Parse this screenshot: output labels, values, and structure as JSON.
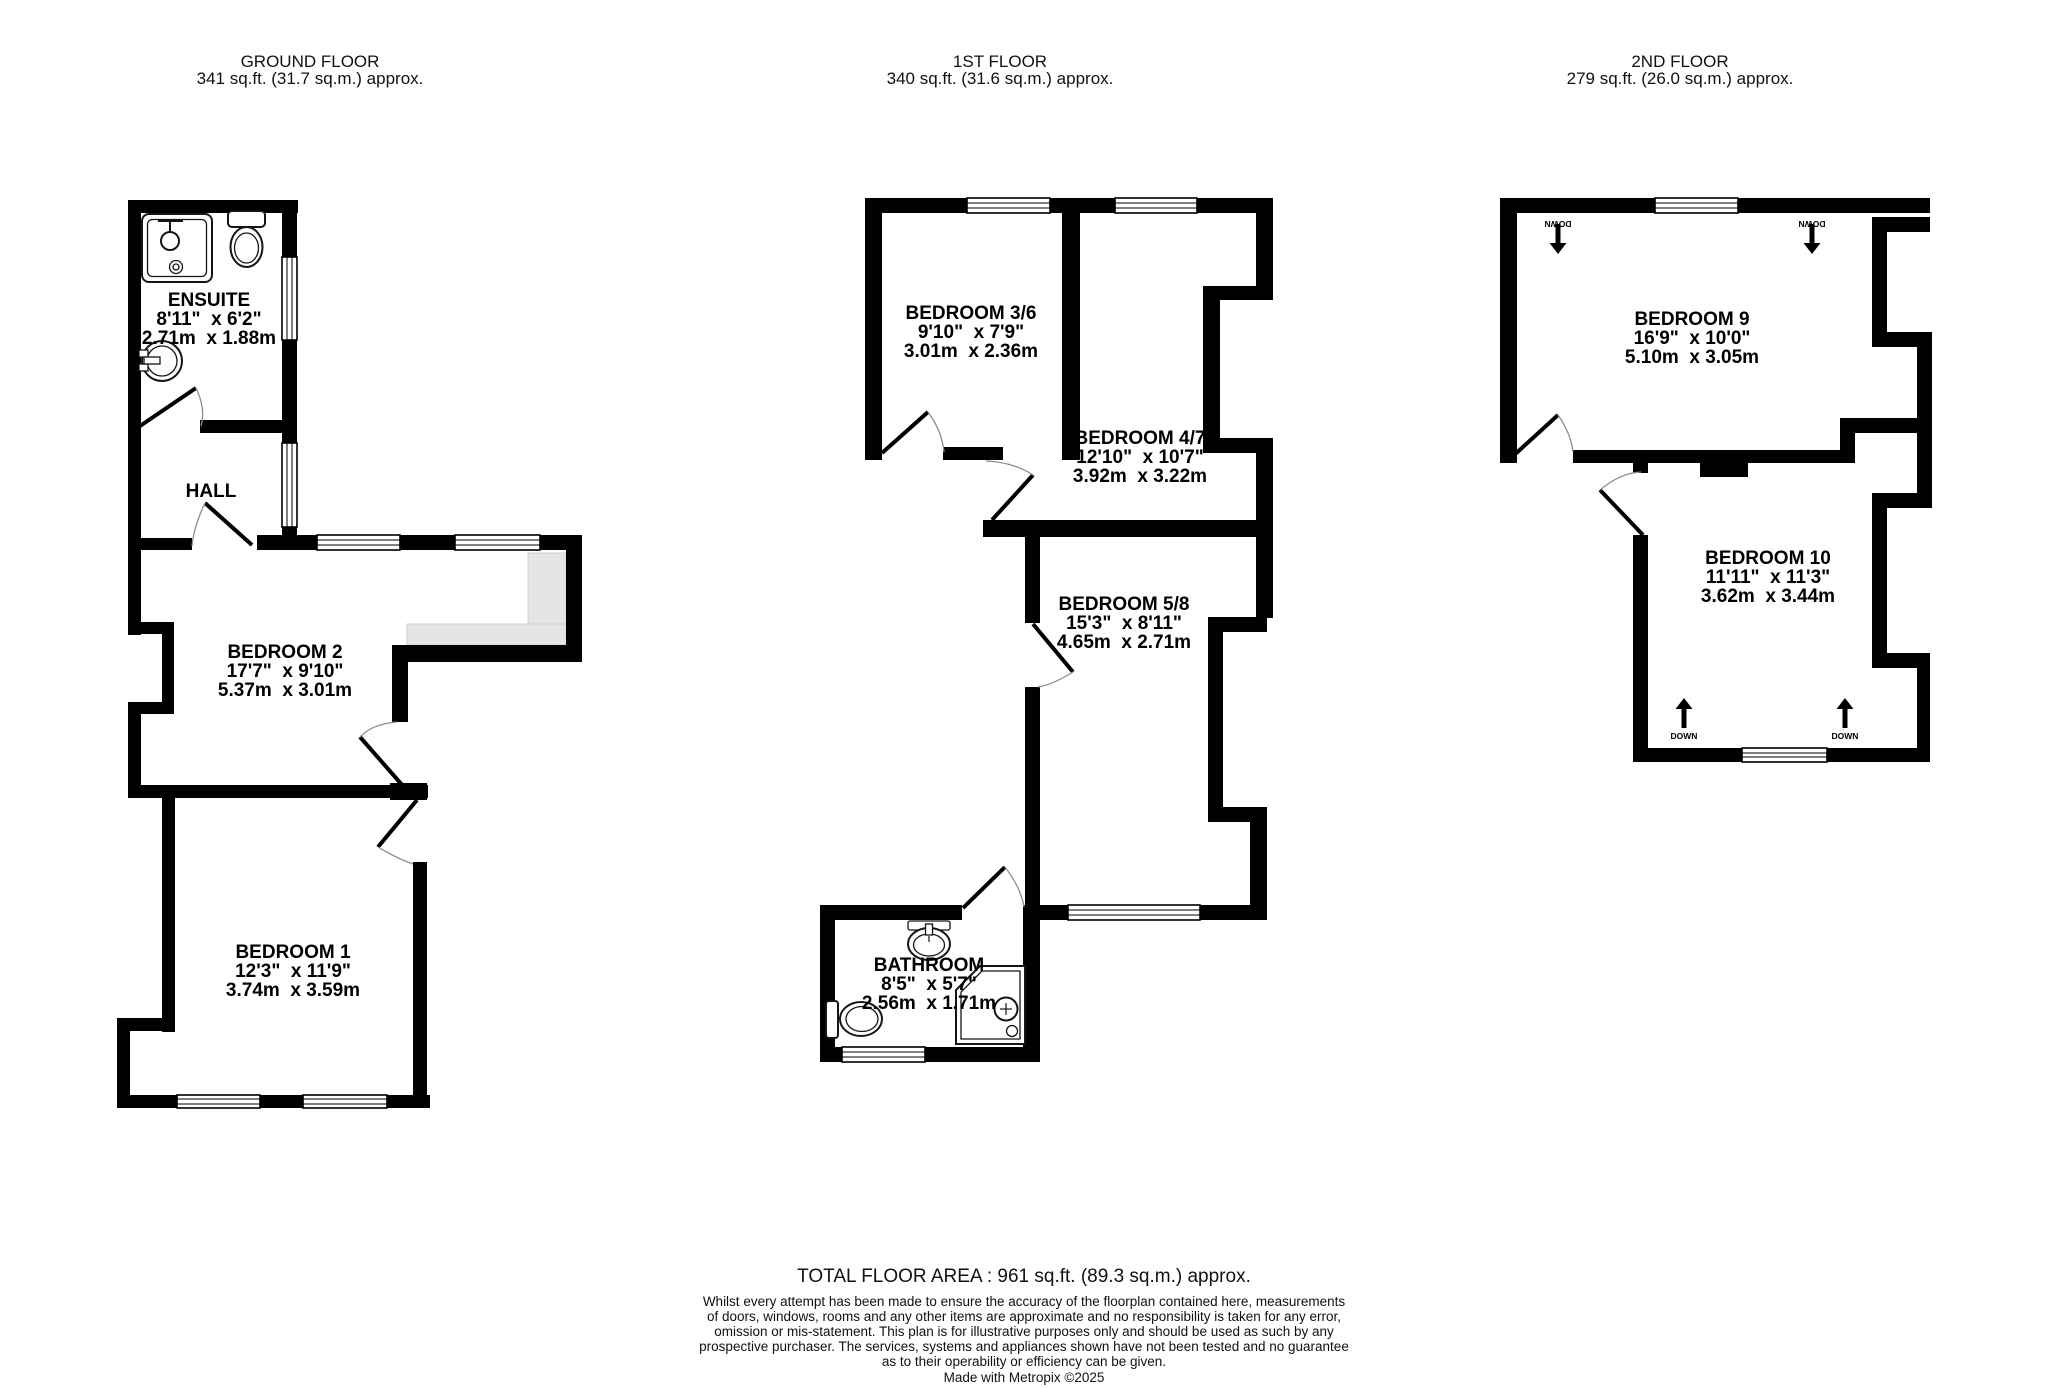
{
  "ground": {
    "label": "GROUND FLOOR",
    "area": "341 sq.ft. (31.7 sq.m.) approx."
  },
  "first": {
    "label": "1ST FLOOR",
    "area": "340 sq.ft. (31.6 sq.m.) approx."
  },
  "second": {
    "label": "2ND FLOOR",
    "area": "279 sq.ft. (26.0 sq.m.) approx."
  },
  "rooms": {
    "ensuite": {
      "name": "ENSUITE",
      "imperial": "8'11\"  x 6'2\"",
      "metric": "2.71m  x 1.88m"
    },
    "hall": {
      "name": "HALL"
    },
    "bedroom2": {
      "name": "BEDROOM 2",
      "imperial": "17'7\"  x 9'10\"",
      "metric": "5.37m  x 3.01m"
    },
    "bedroom1": {
      "name": "BEDROOM 1",
      "imperial": "12'3\"  x 11'9\"",
      "metric": "3.74m  x 3.59m"
    },
    "bedroom36": {
      "name": "BEDROOM 3/6",
      "imperial": "9'10\"  x 7'9\"",
      "metric": "3.01m  x 2.36m"
    },
    "bedroom47": {
      "name": "BEDROOM 4/7",
      "imperial": "12'10\"  x 10'7\"",
      "metric": "3.92m  x 3.22m"
    },
    "bedroom58": {
      "name": "BEDROOM 5/8",
      "imperial": "15'3\"  x 8'11\"",
      "metric": "4.65m  x 2.71m"
    },
    "bathroom": {
      "name": "BATHROOM",
      "imperial": "8'5\"  x 5'7\"",
      "metric": "2.56m  x 1.71m"
    },
    "bedroom9": {
      "name": "BEDROOM 9",
      "imperial": "16'9\"  x 10'0\"",
      "metric": "5.10m  x 3.05m"
    },
    "bedroom10": {
      "name": "BEDROOM 10",
      "imperial": "11'11\"  x 11'3\"",
      "metric": "3.62m  x 3.44m"
    }
  },
  "stairs": {
    "down_label": "DOWN"
  },
  "footer": {
    "total": "TOTAL FLOOR AREA : 961 sq.ft. (89.3 sq.m.) approx.",
    "disclaimer_lines": [
      "Whilst every attempt has been made to ensure the accuracy of the floorplan contained here, measurements",
      "of doors, windows, rooms and any other items are approximate and no responsibility is taken for any error,",
      "omission or mis-statement. This plan is for illustrative purposes only and should be used as such by any",
      "prospective purchaser. The services, systems and appliances shown have not been tested and no guarantee",
      "as to their operability or efficiency can be given."
    ],
    "credit": "Made with Metropix ©2025"
  },
  "colors": {
    "wall": "#000000",
    "background": "#ffffff",
    "reduced_headroom": "#e5e5e5"
  }
}
